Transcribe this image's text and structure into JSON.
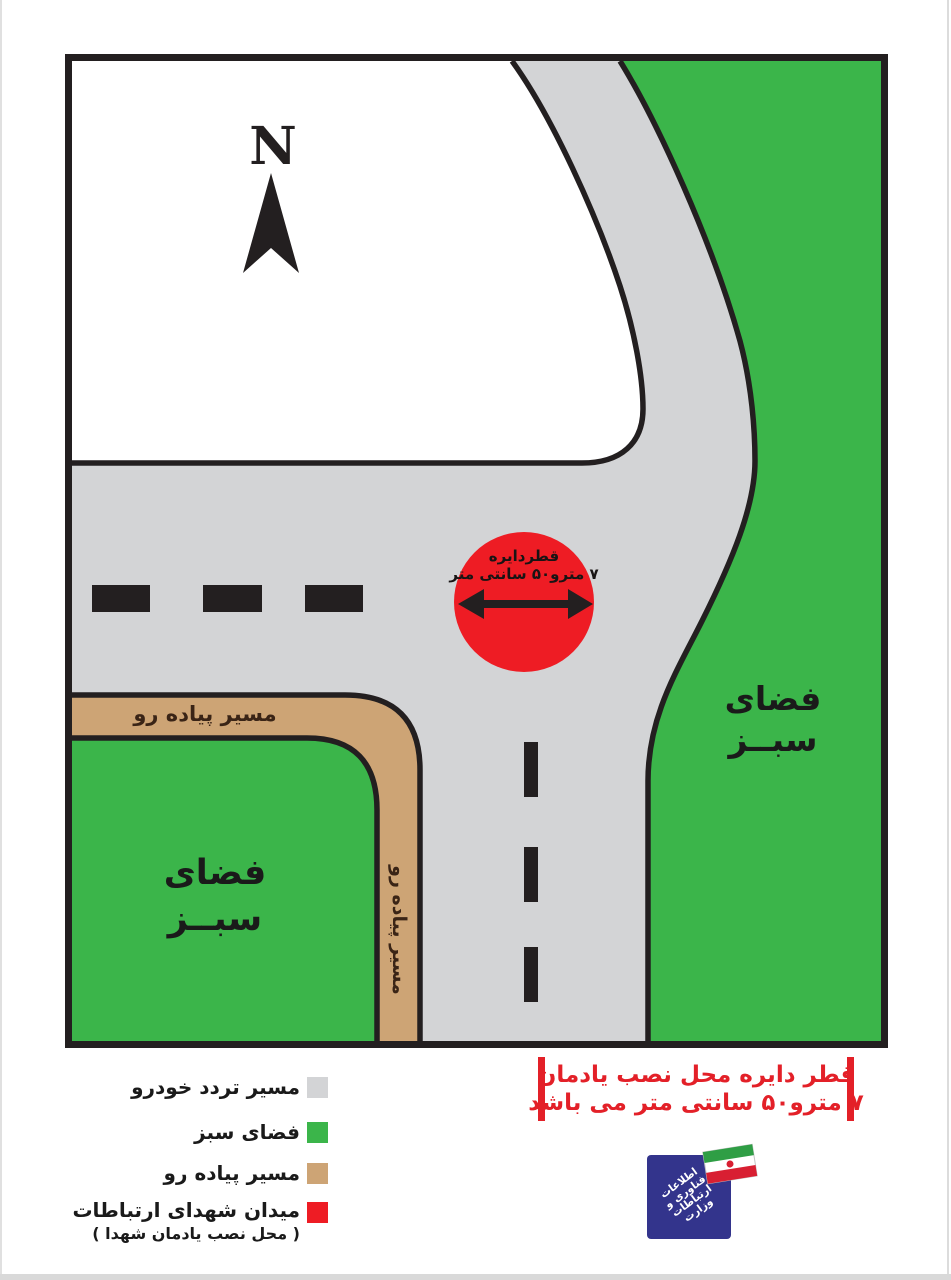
{
  "colors": {
    "outline": "#231f20",
    "road_gray": "#d3d4d6",
    "green_space": "#3bb54a",
    "sidewalk_tan": "#cda475",
    "monument_red": "#ee1c24",
    "info_text_red": "#e32028",
    "logo_blue": "#33348c"
  },
  "compass": {
    "label": "N"
  },
  "map": {
    "circle": {
      "line1": "قطردایره",
      "line2": "۷ مترو۵۰ سانتی متر"
    },
    "green_right": {
      "line1": "فضای",
      "line2": "سبــز"
    },
    "green_left": {
      "line1": "فضای",
      "line2": "سبــز"
    },
    "sidewalk_label_top": "مسیر پیاده رو",
    "sidewalk_label_side": "مسیر پیاده رو"
  },
  "legend": {
    "items": [
      {
        "label": "مسیر تردد خودرو",
        "color": "#d3d4d6"
      },
      {
        "label": "فضای سبز",
        "color": "#3bb54a"
      },
      {
        "label": "مسیر پیاده رو",
        "color": "#cda475"
      },
      {
        "label": "میدان شهدای ارتباطات",
        "sublabel": "( محل نصب یادمان شهدا )",
        "color": "#ee1c24"
      }
    ]
  },
  "info_box": {
    "line1": "قطر دایره محل نصب یادمان",
    "line2": "۷ مترو۵۰ سانتی متر می باشد"
  },
  "logo": {
    "lines": [
      "اطلاعات",
      "فناوری و",
      "ارتباطات",
      "وزارت"
    ]
  }
}
